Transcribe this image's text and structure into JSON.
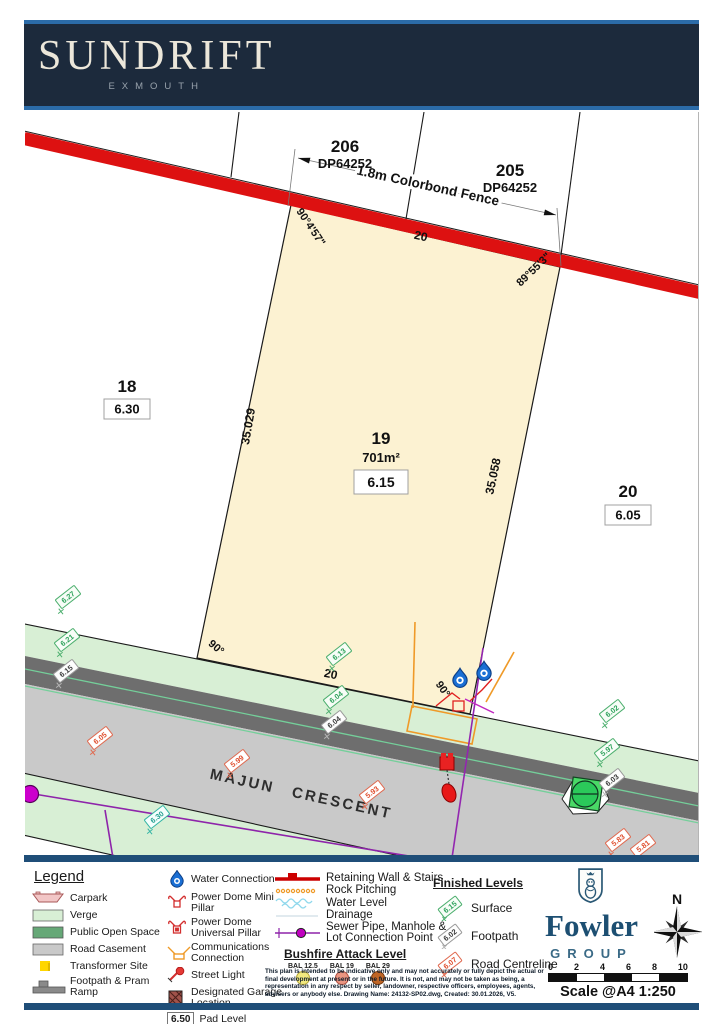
{
  "header": {
    "title": "SUNDRIFT",
    "subtitle": "EXMOUTH"
  },
  "plan": {
    "lot206": {
      "number": "206",
      "ref": "DP64252"
    },
    "lot205": {
      "number": "205",
      "ref": "DP64252"
    },
    "lot18": {
      "number": "18",
      "pad": "6.30"
    },
    "lot19": {
      "number": "19",
      "area": "701m²",
      "pad": "6.15"
    },
    "lot20": {
      "number": "20",
      "pad": "6.05"
    },
    "fence_label": "1.8m Colorbond Fence",
    "dim_top": "20",
    "dim_bottom": "20",
    "dim_left": "35.029",
    "dim_right": "35.058",
    "bearing_top_left": "90°4'57\"",
    "bearing_top_right": "89°55'3\"",
    "bearing_bottom_left": "90°",
    "bearing_bottom_right": "90°",
    "road": {
      "word1": "MAJUN",
      "word2": "CRESCENT"
    },
    "levels": [
      {
        "value": "6.27",
        "type": "surface"
      },
      {
        "value": "6.21",
        "type": "surface"
      },
      {
        "value": "6.15",
        "type": "footpath"
      },
      {
        "value": "6.05",
        "type": "road"
      },
      {
        "value": "5.99",
        "type": "road"
      },
      {
        "value": "6.13",
        "type": "surface"
      },
      {
        "value": "6.04",
        "type": "surface"
      },
      {
        "value": "6.04",
        "type": "footpath"
      },
      {
        "value": "5.93",
        "type": "road"
      },
      {
        "value": "6.02",
        "type": "surface"
      },
      {
        "value": "5.97",
        "type": "surface"
      },
      {
        "value": "6.03",
        "type": "footpath"
      },
      {
        "value": "5.83",
        "type": "road"
      },
      {
        "value": "5.81",
        "type": "road"
      },
      {
        "value": "6.30",
        "type": "water"
      }
    ]
  },
  "legend": {
    "title": "Legend",
    "areas": [
      {
        "label": "Carpark"
      },
      {
        "label": "Verge"
      },
      {
        "label": "Public Open Space"
      },
      {
        "label": "Road Casement"
      },
      {
        "label": "Transformer Site"
      },
      {
        "label": "Footpath & Pram Ramp"
      }
    ],
    "symbols": [
      {
        "label": "Water Connection"
      },
      {
        "label": "Power Dome Mini Pillar"
      },
      {
        "label": "Power Dome Universal Pillar"
      },
      {
        "label": "Communications Connection"
      },
      {
        "label": "Street Light"
      },
      {
        "label": "Designated Garage Location"
      }
    ],
    "pad": {
      "value": "6.50",
      "label": "Pad Level"
    },
    "lines": [
      {
        "label": "Retaining Wall & Stairs"
      },
      {
        "label": "Rock Pitching"
      },
      {
        "label": "Water Level"
      },
      {
        "label": "Drainage"
      },
      {
        "label": "Sewer Pipe, Manhole & Lot Connection Point"
      }
    ],
    "bushfire": {
      "title": "Bushfire Attack Level",
      "items": [
        {
          "label": "BAL 12.5",
          "color": "#f2e97f"
        },
        {
          "label": "BAL 19",
          "color": "#ea9581"
        },
        {
          "label": "BAL 29",
          "color": "#bf6526"
        }
      ]
    },
    "finished": {
      "title": "Finished Levels",
      "items": [
        {
          "value": "6.15",
          "label": "Surface",
          "type": "surface"
        },
        {
          "value": "6.02",
          "label": "Footpath",
          "type": "footpath"
        },
        {
          "value": "6.07",
          "label": "Road Centreline",
          "type": "road"
        }
      ]
    },
    "disclaimer": "This plan is intended to be indicative only and may not accurately or fully depict the actual or final development at present or in the future. It is not, and may not be taken as being, a representation in any respect by seller, landowner, respective officers, employees, agents, advisers or anybody else. Drawing Name: 24132-SP02.dwg, Created: 30.01.2026, V5."
  },
  "branding": {
    "company": "Fowler",
    "group": "GROUP"
  },
  "compass": {
    "label": "N"
  },
  "scalebar": {
    "ticks": [
      "0",
      "2",
      "4",
      "6",
      "8",
      "10"
    ],
    "label": "Scale @A4 1:250"
  },
  "colors": {
    "fence_red": "#dd1111",
    "lot_fill": "#fcf2d2",
    "verge_green": "#d8efd5",
    "open_space_green": "#66a877",
    "road_gray": "#c9c9c9",
    "footpath_gray": "#6e6e6e",
    "header_navy": "#1c2a3c",
    "accent_blue": "#2b6ba8",
    "brand_navy": "#1d4f72",
    "sewer_purple": "#8e24aa",
    "comms_orange": "#ef9a28",
    "water_blue": "#1a6fd4",
    "surface_green": "#2fa35c",
    "road_level_red": "#e05030"
  }
}
